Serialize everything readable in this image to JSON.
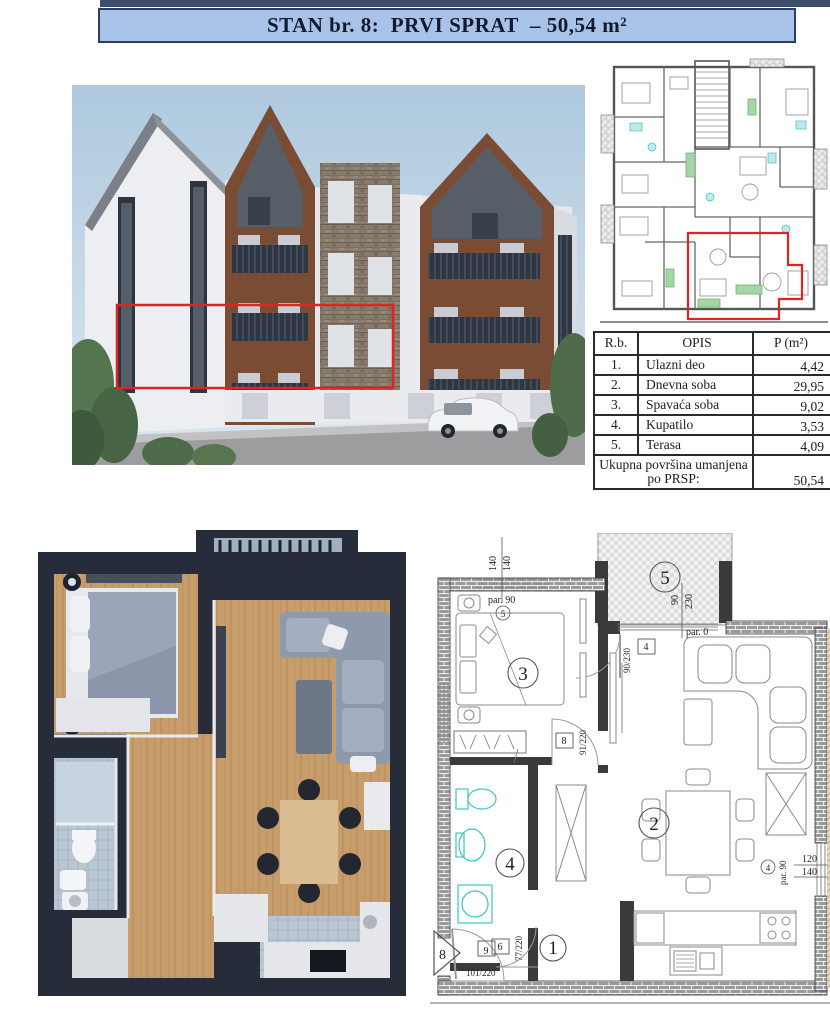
{
  "banner": {
    "title": "STAN br. 8:  PRVI SPRAT  – 50,54 m²",
    "bg": "#a9c3e8",
    "border": "#2c3e5f",
    "top_strip": "#3d4d6b"
  },
  "area_table": {
    "headers": {
      "num": "R.b.",
      "desc": "OPIS",
      "area": "P (m²)"
    },
    "rows": [
      {
        "num": "1.",
        "desc": "Ulazni deo",
        "area": "4,42"
      },
      {
        "num": "2.",
        "desc": "Dnevna soba",
        "area": "29,95"
      },
      {
        "num": "3.",
        "desc": "Spavaća soba",
        "area": "9,02"
      },
      {
        "num": "4.",
        "desc": "Kupatilo",
        "area": "3,53"
      },
      {
        "num": "5.",
        "desc": "Terasa",
        "area": "4,09"
      }
    ],
    "total_label": "Ukupna površina umanjena po PRSP:",
    "total_value": "50,54"
  },
  "floor_plan": {
    "rooms": {
      "entry": "1",
      "living": "2",
      "bedroom": "3",
      "bathroom": "4",
      "terrace": "5"
    },
    "dims": {
      "top_w1": "140",
      "top_w2": "140",
      "top_par": "par. 90",
      "top_win_ref": "5",
      "terrace_w": "90",
      "terrace_h": "230",
      "terrace_par": "par. 0",
      "terrace_door_ref": "4",
      "terrace_door_dim": "90/230",
      "bedroom_door_ref": "8",
      "bedroom_door_dim": "91/220",
      "bath_door_ref": "6",
      "bath_door_dim": "77/220",
      "entry_door_ref": "9",
      "entry_door_dim": "101/220",
      "apartment_marker": "8",
      "right_win_ref": "4",
      "right_win_par": "par. 90",
      "right_win_w": "120",
      "right_win_h": "140"
    }
  },
  "colors": {
    "highlight_red": "#e02424",
    "wall_dark": "#2a303d",
    "plan_line": "#555555",
    "fixture_teal": "#3fc4c0",
    "furniture_green": "#a5d6a5"
  }
}
